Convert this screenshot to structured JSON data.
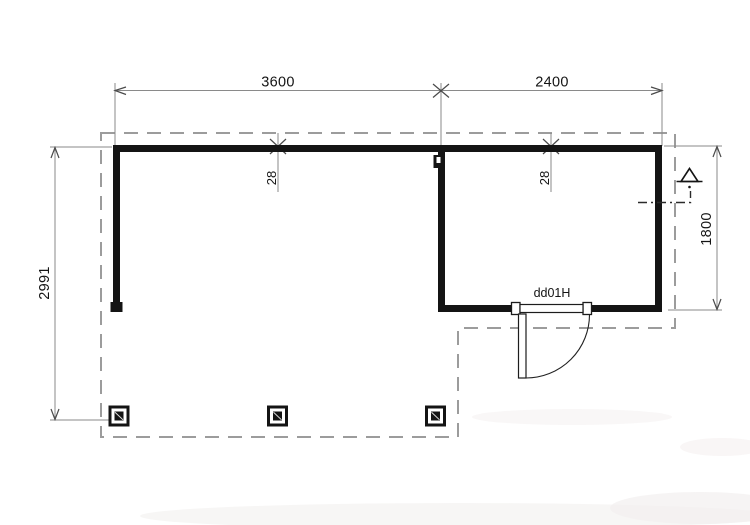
{
  "drawing": {
    "type": "floor-plan",
    "dimensions": {
      "top_left_span": "3600",
      "top_right_span": "2400",
      "left_height": "2991",
      "right_height": "1800",
      "wall_thickness_left": "28",
      "wall_thickness_right": "28"
    },
    "labels": {
      "door": "dd01H"
    },
    "colors": {
      "wall": "#141414",
      "dimension_line": "#8a8a8a",
      "dashed_outline": "#9c9c9c",
      "text": "#141414",
      "background": "#ffffff"
    }
  }
}
